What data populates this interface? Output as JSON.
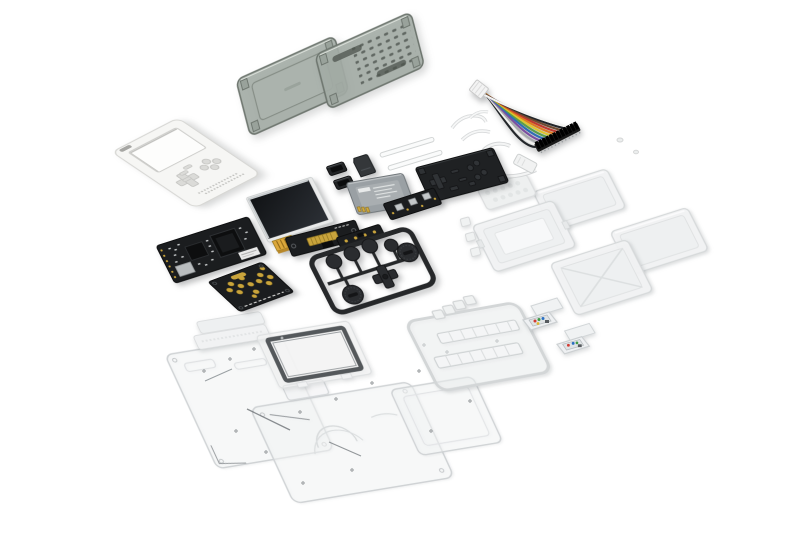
{
  "scene": {
    "type": "product-photo",
    "subject": "Exploded flat-lay of a DIY handheld game console kit on a white background",
    "background_color": "#ffffff"
  },
  "palette": {
    "shell_white": "#f6f6f4",
    "smoke_case": "#a4ada6",
    "pcb_black": "#1b1d1f",
    "gold": "#c9a43c",
    "battery_gray": "#9aa0a4",
    "rubber_black": "#1f2123",
    "screen_black": "#17191c",
    "silver": "#c7cbcd",
    "sprue_black": "#2a2c2f",
    "acrylic_edge": "#d3d6d8"
  },
  "rainbow_cable": {
    "plug_color": "#f3f3f3",
    "connector_color": "#1a1a1a",
    "wire_colors": [
      "#23262a",
      "#f2f2f0",
      "#a7a9ab",
      "#7b4fa0",
      "#2f6db5",
      "#5a9e4a",
      "#ddc62e",
      "#df7b20",
      "#c03a2e",
      "#6e4a2f",
      "#23262a",
      "#f2f2f0"
    ]
  },
  "parts": [
    {
      "id": "white-front-shell",
      "label": "White handheld front shell with screen, D-pad and button cutouts",
      "count": 1
    },
    {
      "id": "smoke-case-bottom",
      "label": "Smoke translucent case bottom half",
      "count": 1
    },
    {
      "id": "smoke-case-lid",
      "label": "Smoke translucent case lid with vent slots",
      "count": 1
    },
    {
      "id": "rainbow-cable",
      "label": "Rainbow GPIO jumper ribbon cable",
      "count": 1
    },
    {
      "id": "white-cable",
      "label": "White cable loop with connector",
      "count": 1
    },
    {
      "id": "zip-ties",
      "label": "White zip ties",
      "count": 3
    },
    {
      "id": "clear-rods",
      "label": "Clear support rods",
      "count": 2
    },
    {
      "id": "micro-sd-card",
      "label": "Micro SD card",
      "count": 1
    },
    {
      "id": "connector-housings",
      "label": "Black connector housings",
      "count": 2
    },
    {
      "id": "battery",
      "label": "Gray lithium battery with label",
      "count": 1
    },
    {
      "id": "rubber-keypad-mat",
      "label": "Black rubber keypad mat with nubs",
      "count": 1
    },
    {
      "id": "lcd-display",
      "label": "LCD display with gold flex cable",
      "count": 1
    },
    {
      "id": "mainboard",
      "label": "Mainboard PCB with CPU and shield",
      "count": 1
    },
    {
      "id": "keypad-pcb",
      "label": "Keypad PCB with gold contact pads",
      "count": 1
    },
    {
      "id": "driver-board",
      "label": "Display driver board with gold connector",
      "count": 1
    },
    {
      "id": "switch-strip",
      "label": "Strip PCB with tactile switches",
      "count": 1
    },
    {
      "id": "component-strip",
      "label": "Small component strip PCB",
      "count": 1
    },
    {
      "id": "button-sprue",
      "label": "Black button sprue with D-pad, round buttons and dials",
      "count": 1
    },
    {
      "id": "frosted-strip",
      "label": "Frosted textured membrane strip",
      "count": 1
    },
    {
      "id": "clear-case-a",
      "label": "Clear module case",
      "count": 1
    },
    {
      "id": "clear-case-b",
      "label": "Clear module case with inner tray",
      "count": 1
    },
    {
      "id": "clear-case-c",
      "label": "Clear module case",
      "count": 1
    },
    {
      "id": "clear-case-d",
      "label": "Clear module case with ridged lid",
      "count": 1
    },
    {
      "id": "clear-key-cubes",
      "label": "Small clear key cubes",
      "count": 3
    },
    {
      "id": "clear-sprue",
      "label": "Clear parts sprue with key bars",
      "count": 1
    },
    {
      "id": "mini-modules",
      "label": "Mini clear modules with colored electronics",
      "count": 2
    },
    {
      "id": "acrylic-strips",
      "label": "Slim acrylic strips",
      "count": 2
    },
    {
      "id": "screen-glass",
      "label": "Screen glass with dark bezel frame",
      "count": 1
    },
    {
      "id": "acrylic-panel-left",
      "label": "Laser-cut clear acrylic panel",
      "count": 1
    },
    {
      "id": "acrylic-panel-center",
      "label": "Laser-cut clear acrylic panel with speaker arcs",
      "count": 1
    },
    {
      "id": "acrylic-panel-right",
      "label": "Laser-cut clear acrylic panel",
      "count": 1
    },
    {
      "id": "screws",
      "label": "Small assembly screws",
      "count": 18
    }
  ]
}
